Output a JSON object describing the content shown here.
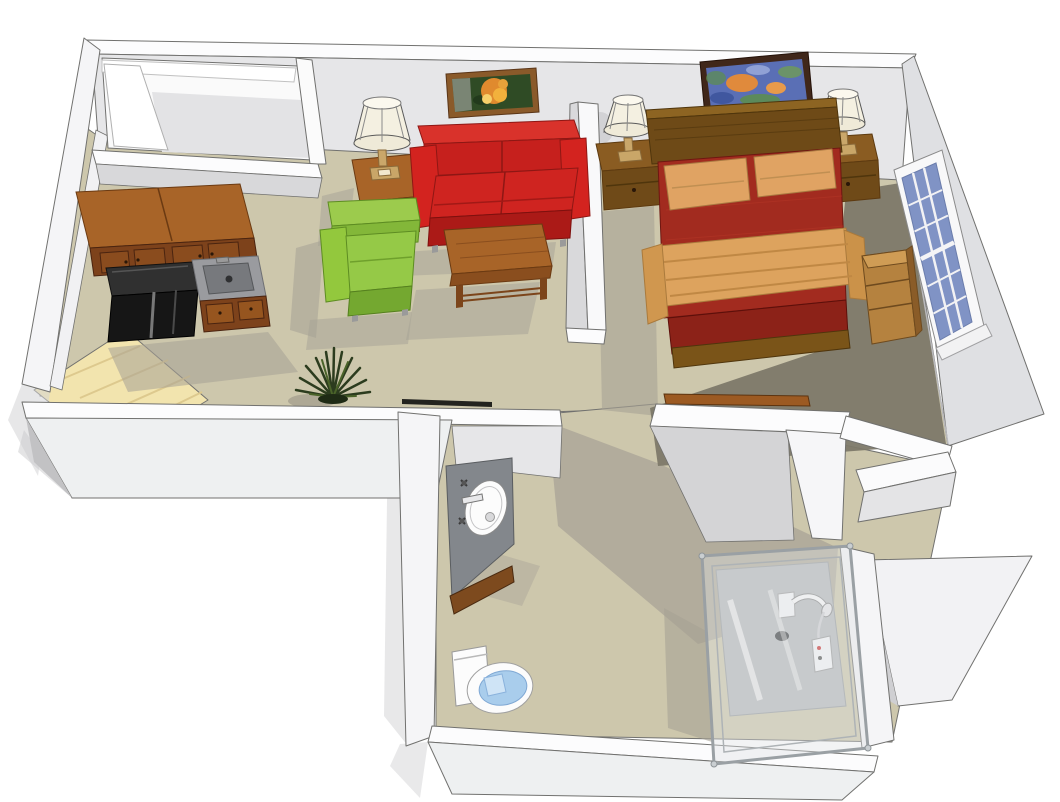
{
  "scene": {
    "title": "3D isometric cutaway floor plan of a studio apartment",
    "view": "axonometric overhead cutaway",
    "rooms": [
      {
        "id": "entry-closet",
        "label": "Entry closet"
      },
      {
        "id": "kitchenette",
        "label": "Kitchenette"
      },
      {
        "id": "living-area",
        "label": "Living area"
      },
      {
        "id": "sleeping-area",
        "label": "Sleeping area"
      },
      {
        "id": "wardrobe",
        "label": "Wardrobe closet"
      },
      {
        "id": "bathroom",
        "label": "Bathroom"
      }
    ],
    "furniture": [
      {
        "id": "upper-cabinets",
        "label": "Kitchen upper cabinets"
      },
      {
        "id": "black-appliance",
        "label": "Black refrigerator / range"
      },
      {
        "id": "sink-counter",
        "label": "Kitchen sink counter"
      },
      {
        "id": "base-drawers",
        "label": "Kitchen base drawers"
      },
      {
        "id": "entry-floor",
        "label": "Entry wood flooring"
      },
      {
        "id": "loveseat",
        "label": "Red loveseat sofa"
      },
      {
        "id": "armchair",
        "label": "Green armchair"
      },
      {
        "id": "end-table",
        "label": "Wood end table with lamp"
      },
      {
        "id": "coffee-table",
        "label": "Wood coffee table"
      },
      {
        "id": "plant",
        "label": "Floor plant"
      },
      {
        "id": "flower-picture",
        "label": "Framed flower picture"
      },
      {
        "id": "abstract-painting",
        "label": "Framed abstract painting"
      },
      {
        "id": "bed",
        "label": "Bed with red spread and tan throw"
      },
      {
        "id": "nightstand-left",
        "label": "Left nightstand with lamp"
      },
      {
        "id": "nightstand-right",
        "label": "Right nightstand with lamp"
      },
      {
        "id": "dresser",
        "label": "Wood dresser shelf"
      },
      {
        "id": "window",
        "label": "Blue multi-pane window"
      },
      {
        "id": "vanity-sink",
        "label": "Bathroom vanity sink"
      },
      {
        "id": "toilet",
        "label": "Toilet with blue seat"
      },
      {
        "id": "shower",
        "label": "Glass shower enclosure"
      }
    ]
  },
  "colors": {
    "wall_white": "#f5f5f7",
    "wall_cap": "#fcfcfd",
    "wall_interior": "#e6e6e8",
    "carpet": "#cdc7ac",
    "carpet_shadow": "#a6a195",
    "carpet_dark": "#7d7969",
    "entry_wood": "#f2e4ae",
    "wood": "#a86428",
    "wood_dark": "#7d421b",
    "appliance_black": "#161616",
    "counter_gray": "#9a9b9f",
    "sofa_red": "#d3231f",
    "chair_green": "#93c83d",
    "bed_red": "#a22b1f",
    "bed_red_dark": "#8c2218",
    "pillow_tan": "#e0a363",
    "blanket_tan": "#dda35e",
    "window_blue": "#8093c5",
    "vanity_gray": "#83878c",
    "porcelain": "#fcfcfc",
    "toilet_seat": "#a9cdec",
    "glass": "#dfe3e5",
    "frame_wood": "#8a5a2a",
    "frame_dark": "#40271a",
    "art_green": "#2f4b25",
    "art_blue": "#5a6fb5",
    "art_orange": "#e08a2e",
    "plant_green": "#2c3c1e",
    "lamp_shade": "#f4f0e1"
  }
}
